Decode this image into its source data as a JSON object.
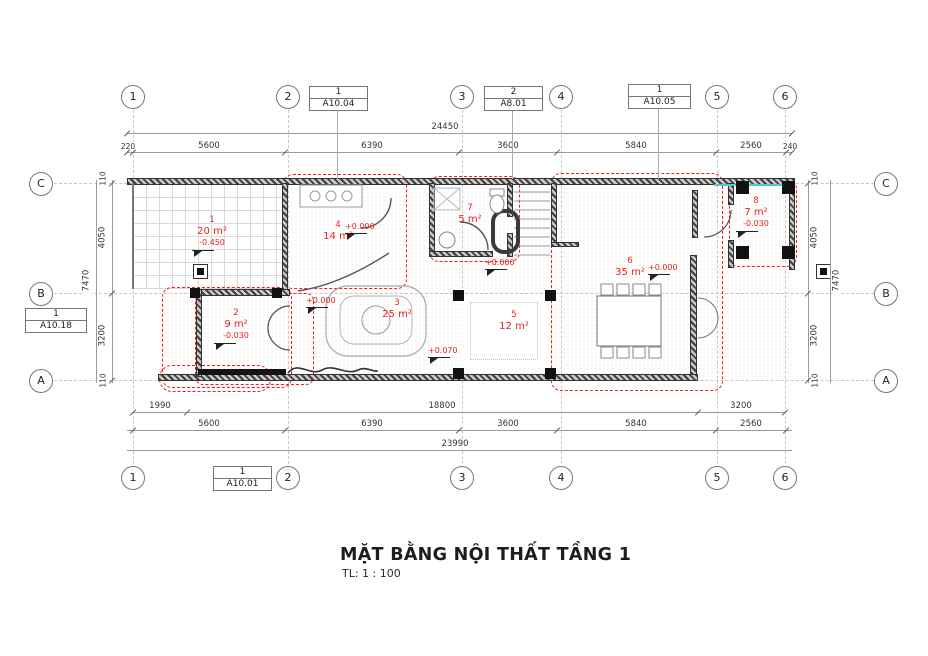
{
  "sheet": {
    "title": "MẶT BẰNG NỘI THẤT TẦNG 1",
    "scale": "TL: 1 : 100"
  },
  "grid": {
    "cols": [
      "1",
      "2",
      "3",
      "4",
      "5",
      "6"
    ],
    "rows": [
      "C",
      "B",
      "A"
    ]
  },
  "callouts": {
    "top1": {
      "num": "1",
      "sheet": "A10.04"
    },
    "top2": {
      "num": "2",
      "sheet": "A8.01"
    },
    "top3": {
      "num": "1",
      "sheet": "A10.05"
    },
    "left": {
      "num": "1",
      "sheet": "A10.18"
    },
    "bottom": {
      "num": "1",
      "sheet": "A10.01"
    }
  },
  "dims": {
    "top_total": "24450",
    "top": [
      "220",
      "5600",
      "6390",
      "3600",
      "5840",
      "2560",
      "240"
    ],
    "side_total": "7470",
    "side": [
      "110",
      "4050",
      "3200",
      "110"
    ],
    "bottom_row1": [
      "1990",
      "18800",
      "3200"
    ],
    "bottom_row2": [
      "5600",
      "6390",
      "3600",
      "5840",
      "2560"
    ],
    "bottom_total": "23990"
  },
  "rooms": [
    {
      "id": "1",
      "area": "20 m²",
      "level": "-0.450"
    },
    {
      "id": "2",
      "area": "9 m²",
      "level": "-0.030"
    },
    {
      "id": "3",
      "area": "25 m²"
    },
    {
      "id": "4",
      "area": "14 m²"
    },
    {
      "id": "5",
      "area": "12 m²"
    },
    {
      "id": "6",
      "area": "35 m²"
    },
    {
      "id": "7",
      "area": "5 m²"
    },
    {
      "id": "8",
      "area": "7 m²",
      "level": "-0.030"
    }
  ],
  "level_markers": [
    "+0.000",
    "+0.000",
    "+0.000",
    "+0.000",
    "+0.070"
  ],
  "colors": {
    "label_red": "#e8231c",
    "zone_red": "#f21d1d",
    "cyan": "#49c8d8",
    "wall": "#3f3f3f"
  }
}
